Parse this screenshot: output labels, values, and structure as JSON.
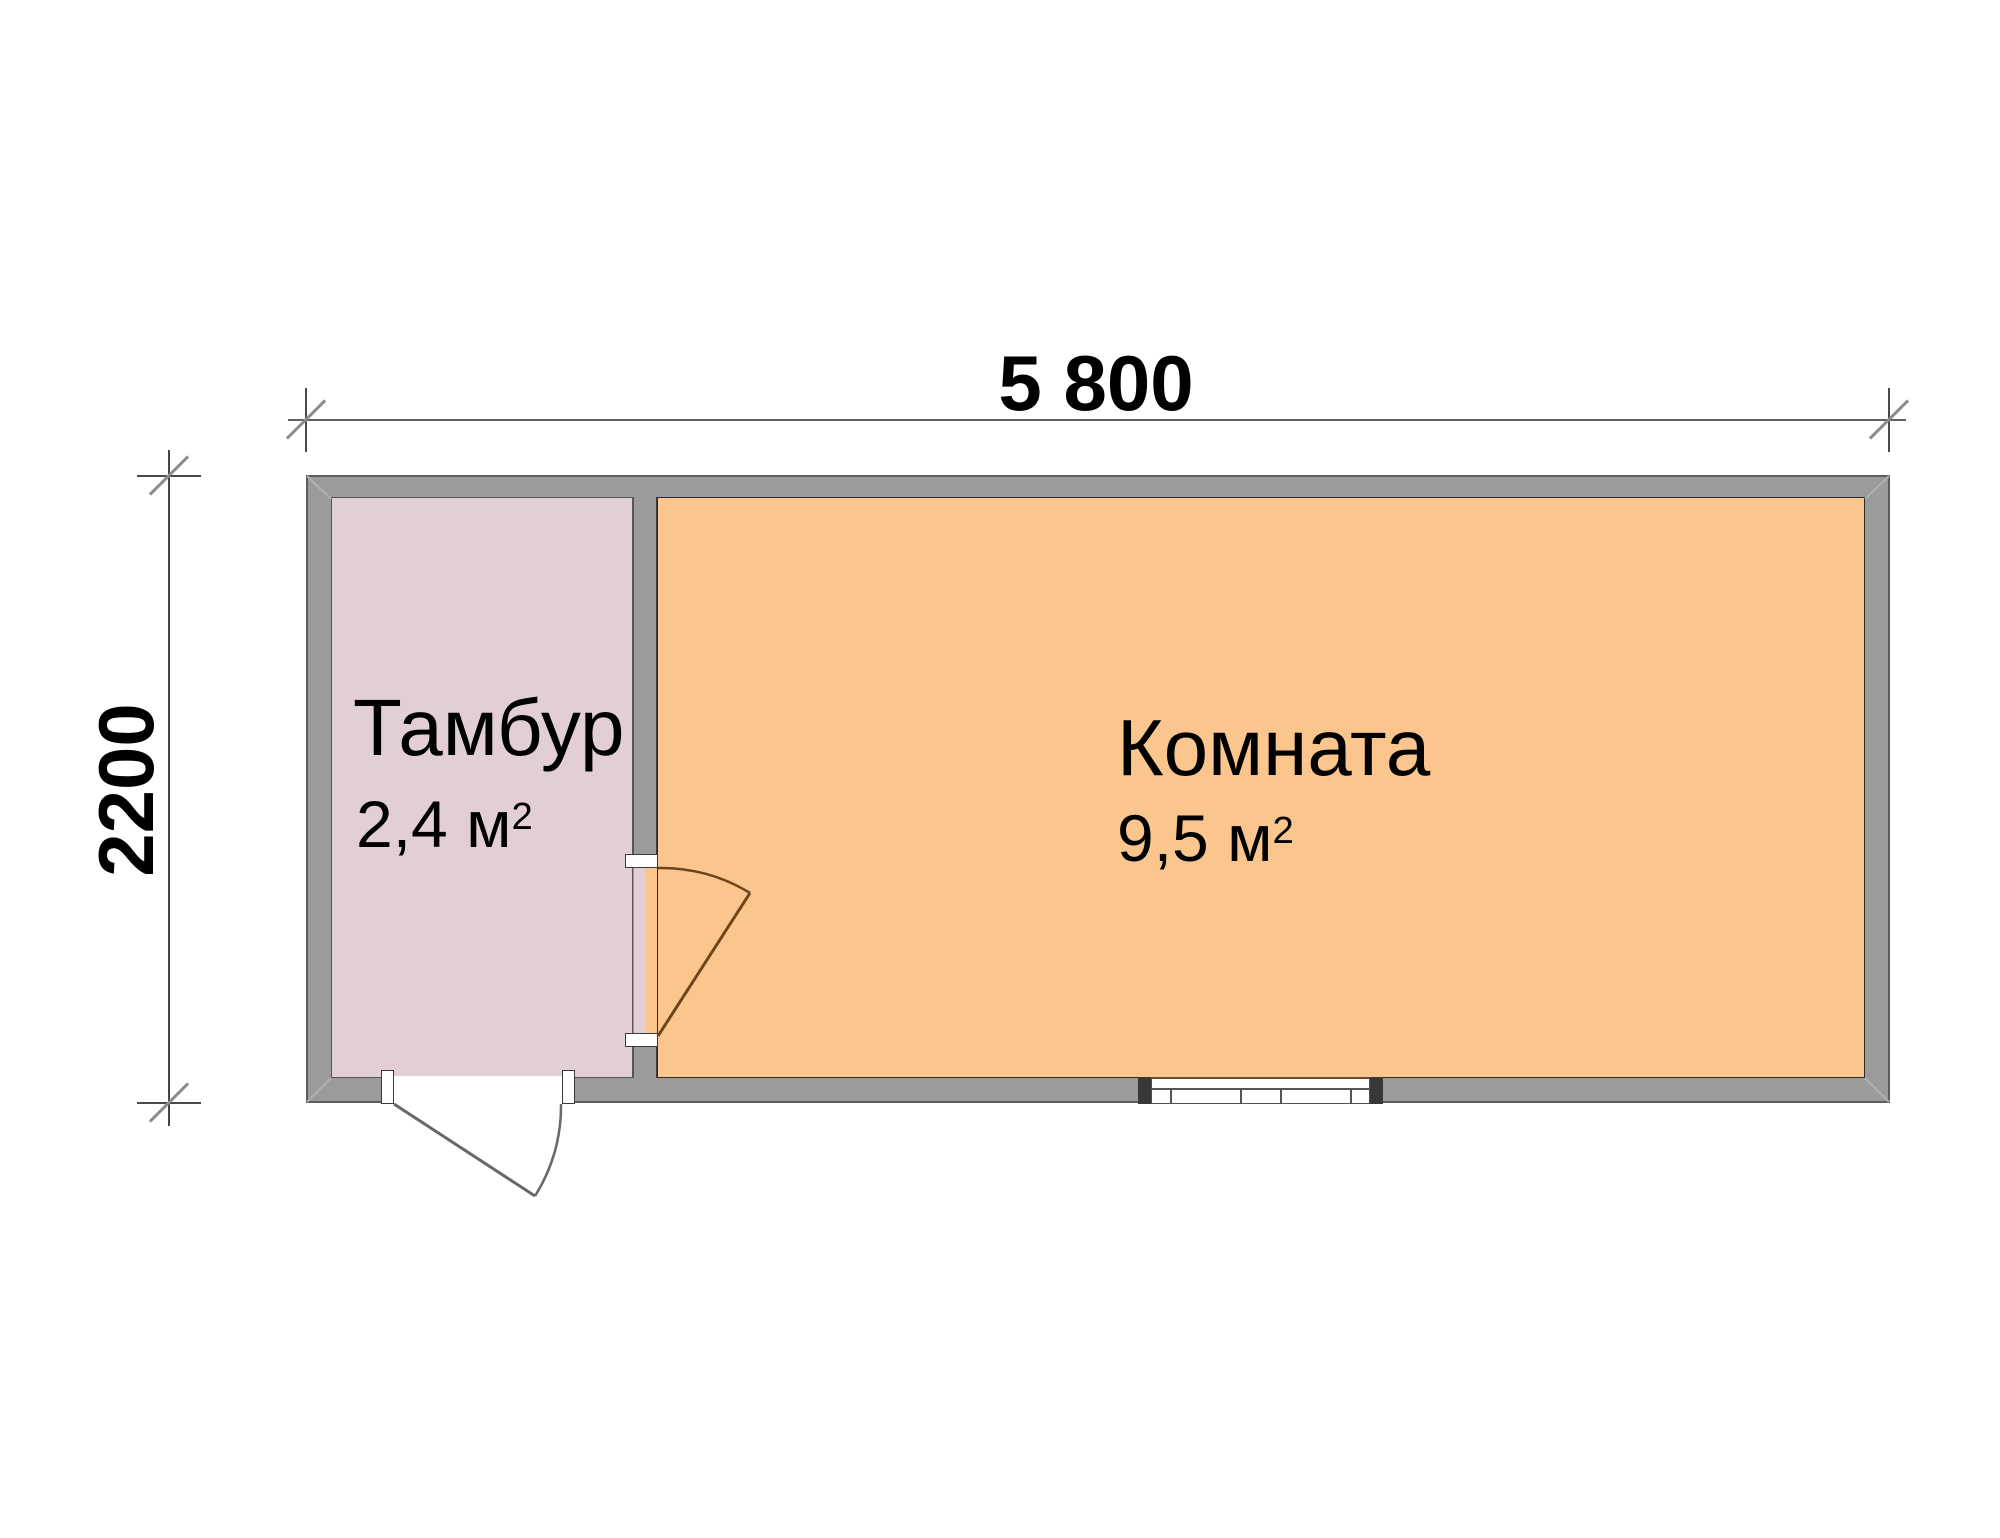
{
  "dimensions": {
    "width_label": "5 800",
    "height_label": "2200"
  },
  "rooms": [
    {
      "name": "Тамбур",
      "area_value": "2,4 м",
      "area_sup": "2",
      "fill": "#e2cfd5"
    },
    {
      "name": "Комната",
      "area_value": "9,5 м",
      "area_sup": "2",
      "fill": "#fbc68e"
    }
  ],
  "colors": {
    "wall": "#9b9b9b",
    "wall_border": "#5d5d5d",
    "tambur_fill": "#e2cfd5",
    "komnata_fill": "#fbc68e",
    "dimension_line": "#5f5f5f",
    "tick": "#8c8c8c",
    "interior_door_line": "#6e4419",
    "exterior_door_line": "#686868",
    "text": "#000000"
  }
}
